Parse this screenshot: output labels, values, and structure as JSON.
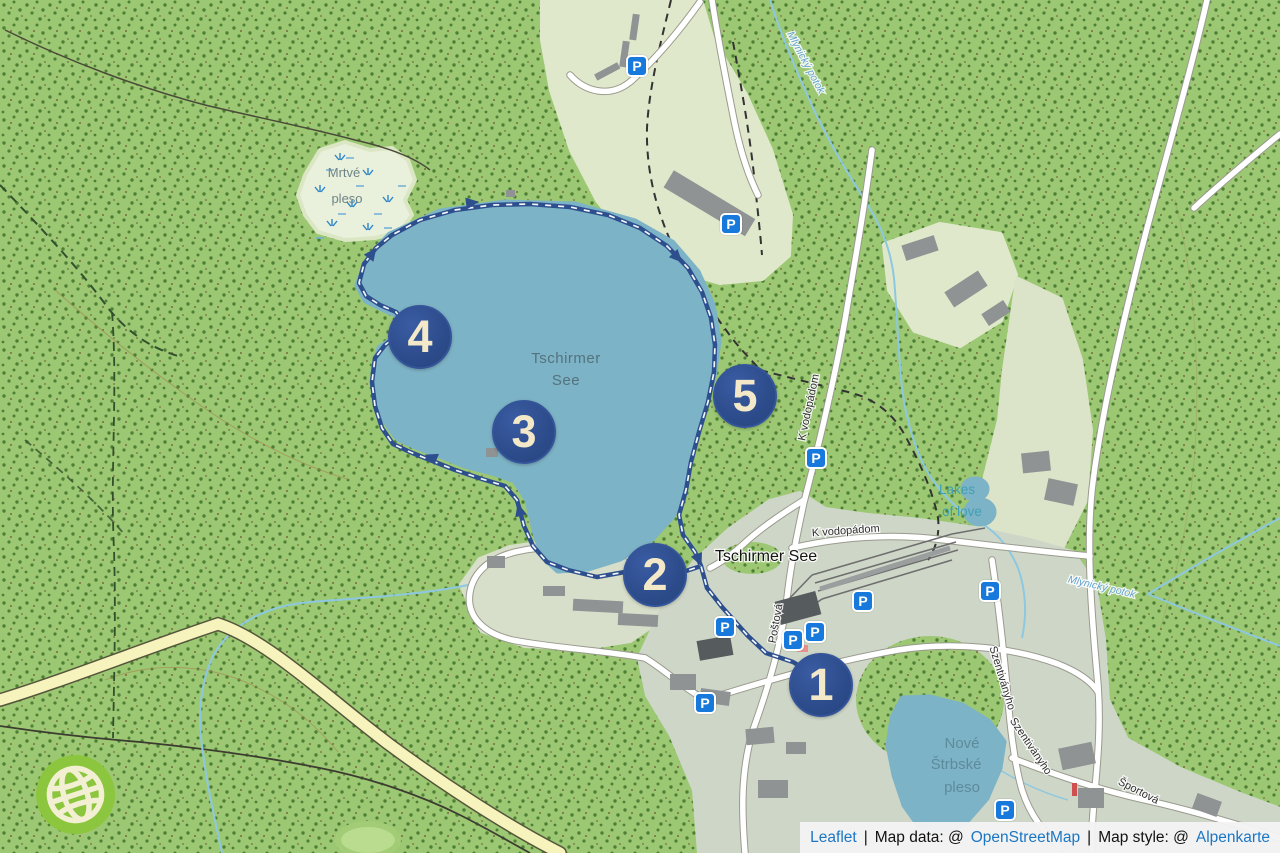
{
  "attribution": {
    "leaflet": "Leaflet",
    "sep1": "|",
    "map_data_prefix": "Map data: @",
    "osm": "OpenStreetMap",
    "sep2": "|",
    "map_style_prefix": "Map style: @",
    "style_name": "Alpenkarte"
  },
  "labels": {
    "lake_main": [
      "Tschirmer",
      "See"
    ],
    "mrtve_pleso": [
      "Mrtvé",
      "pleso"
    ],
    "nove_strbske": [
      "Nové",
      "Štrbské",
      "pleso"
    ],
    "town": "Tschirmer See",
    "street_k_vodopadom_vertical": "K vodopádom",
    "street_k_vodopadom_horizontal": "K vodopádom",
    "street_postova": "Poštová",
    "street_szentivanyho_upper": "Szentiványho",
    "street_szentivanyho_lower": "Szentiványho",
    "street_sportova": "Športová",
    "stream_mlynicky_top": "Mlynický potok",
    "stream_mlynicky_right": "Mlynický potok",
    "lakes_of_love": [
      "Lakes",
      "of love"
    ]
  },
  "route": {
    "color": "#2d4f8e",
    "marker_fill": "#2c4b8a",
    "marker_text_color": "#f3e9c8",
    "markers": [
      {
        "label": "1",
        "x": 821,
        "y": 685
      },
      {
        "label": "2",
        "x": 655,
        "y": 575
      },
      {
        "label": "3",
        "x": 524,
        "y": 432
      },
      {
        "label": "4",
        "x": 420,
        "y": 337
      },
      {
        "label": "5",
        "x": 745,
        "y": 396
      }
    ]
  },
  "parking": {
    "label": "P",
    "color": "#1879dd",
    "positions": [
      [
        637,
        66
      ],
      [
        731,
        224
      ],
      [
        816,
        458
      ],
      [
        863,
        601
      ],
      [
        990,
        591
      ],
      [
        725,
        627
      ],
      [
        793,
        640
      ],
      [
        815,
        632
      ],
      [
        705,
        703
      ],
      [
        1005,
        810
      ]
    ]
  },
  "colors": {
    "forest": "#9cc873",
    "forest_dot": "#4e7f35",
    "clearing": "#e0e8cb",
    "village": "#ced7c7",
    "water": "#7db3c6",
    "stream": "#8ec8e0",
    "road_fill": "#ffffff",
    "road_casing": "#9a9a8e",
    "yellow_road": "#f6f3bd",
    "link_blue": "#1b76c4",
    "logo_green": "#8cc63e"
  }
}
